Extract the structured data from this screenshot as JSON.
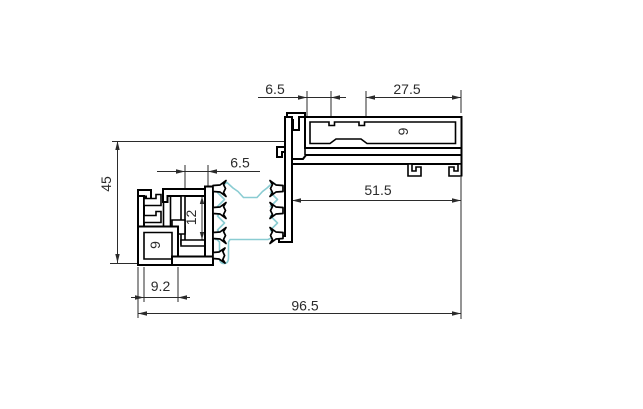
{
  "drawing": {
    "type": "technical-cross-section",
    "description": "Aluminum window frame profile cross-section with thermal gasket",
    "dimensions": {
      "top_offset": "6.5",
      "top_width": "27.5",
      "glazing_channel_height": "9",
      "overall_height": "45",
      "mid_offset": "6.5",
      "frame_width": "51.5",
      "groove_height": "12",
      "lower_box_height": "9",
      "foot_width": "9.2",
      "overall_width": "96.5"
    },
    "colors": {
      "background": "#ffffff",
      "outline": "#000000",
      "dimension": "#2b2b2b",
      "gasket": "#8accd2"
    }
  }
}
